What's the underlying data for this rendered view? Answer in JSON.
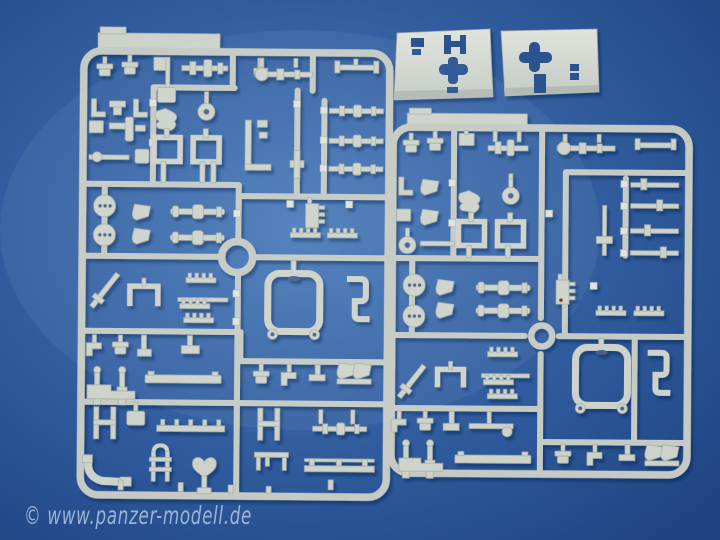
{
  "scene": {
    "description": "Two light grey injection-moulded model-kit sprues full of small parts and two flat hull plates, photographed on a blue background",
    "watermark": "© www.panzer-modell.de"
  },
  "colors": {
    "bg_center": "#4d7ebb",
    "bg_mid": "#305c9e",
    "bg_edge": "#1e4380",
    "plastic": "#c5cac4",
    "plastic_part": "#cdd2cb",
    "plastic_light": "#e0e4dd",
    "plastic_edge": "#a3aaa5",
    "hole": "#4a628a",
    "cutout": "#2b5390",
    "facet": "#b3bab5",
    "watermark": "#aec6e6"
  }
}
